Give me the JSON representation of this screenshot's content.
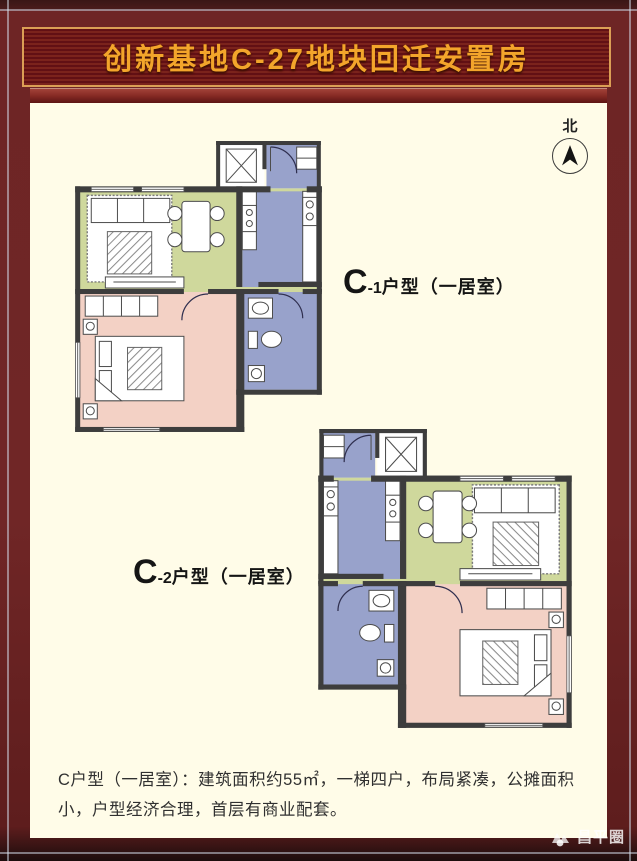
{
  "banner": {
    "title": "创新基地C-27地块回迁安置房"
  },
  "compass": {
    "label": "北"
  },
  "plans": [
    {
      "name": "C-1",
      "label_c": "C",
      "label_num": "-1",
      "label_suffix": "户型（一居室）"
    },
    {
      "name": "C-2",
      "label_c": "C",
      "label_num": "-2",
      "label_suffix": "户型（一居室）"
    }
  ],
  "description": {
    "text": "C户型（一居室）：建筑面积约55㎡，一梯四户，布局紧凑，公摊面积小，户型经济合理，首层有商业配套。"
  },
  "watermark": {
    "label": "昌平圈",
    "icon": "mountain-logo-icon"
  },
  "colors": {
    "frame_maroon": "#6e2525",
    "banner_background": "#6a1217",
    "banner_border_gold": "#db9f55",
    "title_gold": "#f3a52b",
    "content_background": "#fffce8",
    "floor_living_dining": "#cfd89c",
    "floor_kitchen_bath_entry": "#98a2cb",
    "floor_bedroom": "#f3d1c5",
    "wall": "#3d3d3d",
    "description_text": "#303030"
  }
}
